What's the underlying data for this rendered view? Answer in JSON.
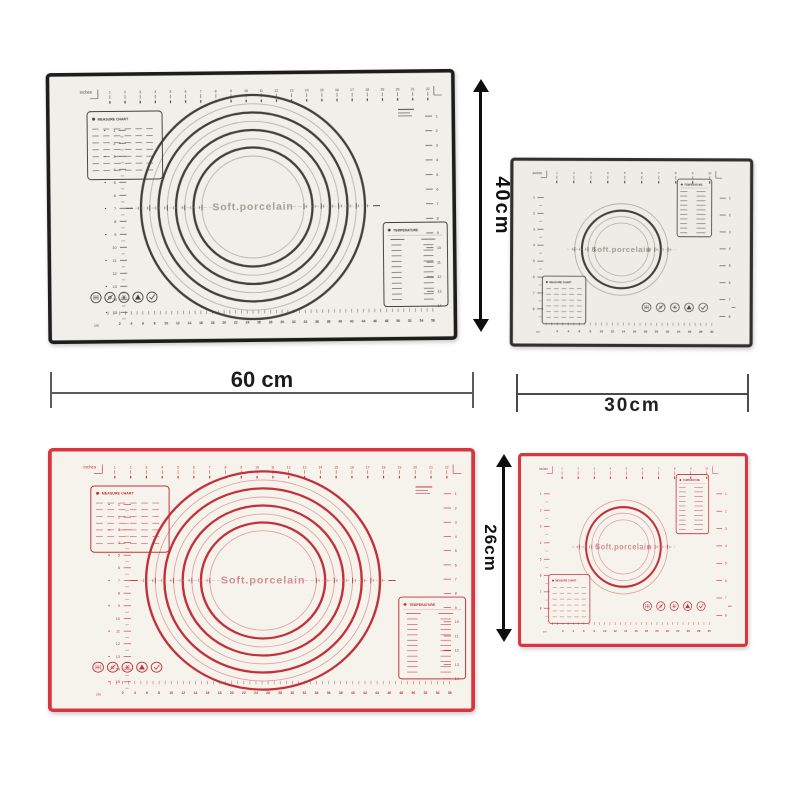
{
  "page": {
    "background": "#ffffff"
  },
  "mat_text": {
    "center_label": "Soft.porcelain",
    "measure_table_title": "MEASURE CHART",
    "temperature_table_title": "TEMPERATURE",
    "top_ruler_unit": "inches",
    "side_ruler_unit": "cm",
    "bottom_ruler_unit": "cm"
  },
  "stamp_icons": [
    "grid-icon",
    "no-cut-icon",
    "snowflake-icon",
    "heat-warning-icon",
    "check-icon"
  ],
  "mats": [
    {
      "id": "large-black",
      "variant": "large",
      "colors": {
        "border": "#1d1d1b",
        "ink": "#413f3c",
        "ink_light": "#b8b4ab",
        "surface": "#f1efe9",
        "center_text": "#a39f95"
      }
    },
    {
      "id": "small-black",
      "variant": "small",
      "colors": {
        "border": "#30302e",
        "ink": "#413f3c",
        "ink_light": "#b5b1a8",
        "surface": "#eeece6",
        "center_text": "#a39f95"
      }
    },
    {
      "id": "large-red",
      "variant": "large",
      "colors": {
        "border": "#d8353e",
        "ink": "#c3323a",
        "ink_light": "#e0a5a2",
        "surface": "#f6f3ed",
        "center_text": "#d29092"
      }
    },
    {
      "id": "small-red",
      "variant": "small",
      "colors": {
        "border": "#d8353e",
        "ink": "#c3323a",
        "ink_light": "#e0a5a2",
        "surface": "#f6f3ed",
        "center_text": "#d29092"
      }
    }
  ],
  "rulers": {
    "large": {
      "top_inch_count": 22,
      "bottom_cm_max": 56,
      "left_count": 15,
      "right_count": 14
    },
    "small": {
      "top_inch_count": 10,
      "bottom_cm_max": 30,
      "left_count": 8,
      "right_count": 8
    }
  },
  "annotations": {
    "large_mat_height": "40cm",
    "large_mat_width": "60 cm",
    "small_mat_width": "30cm",
    "small_mat_height": "26cm"
  }
}
